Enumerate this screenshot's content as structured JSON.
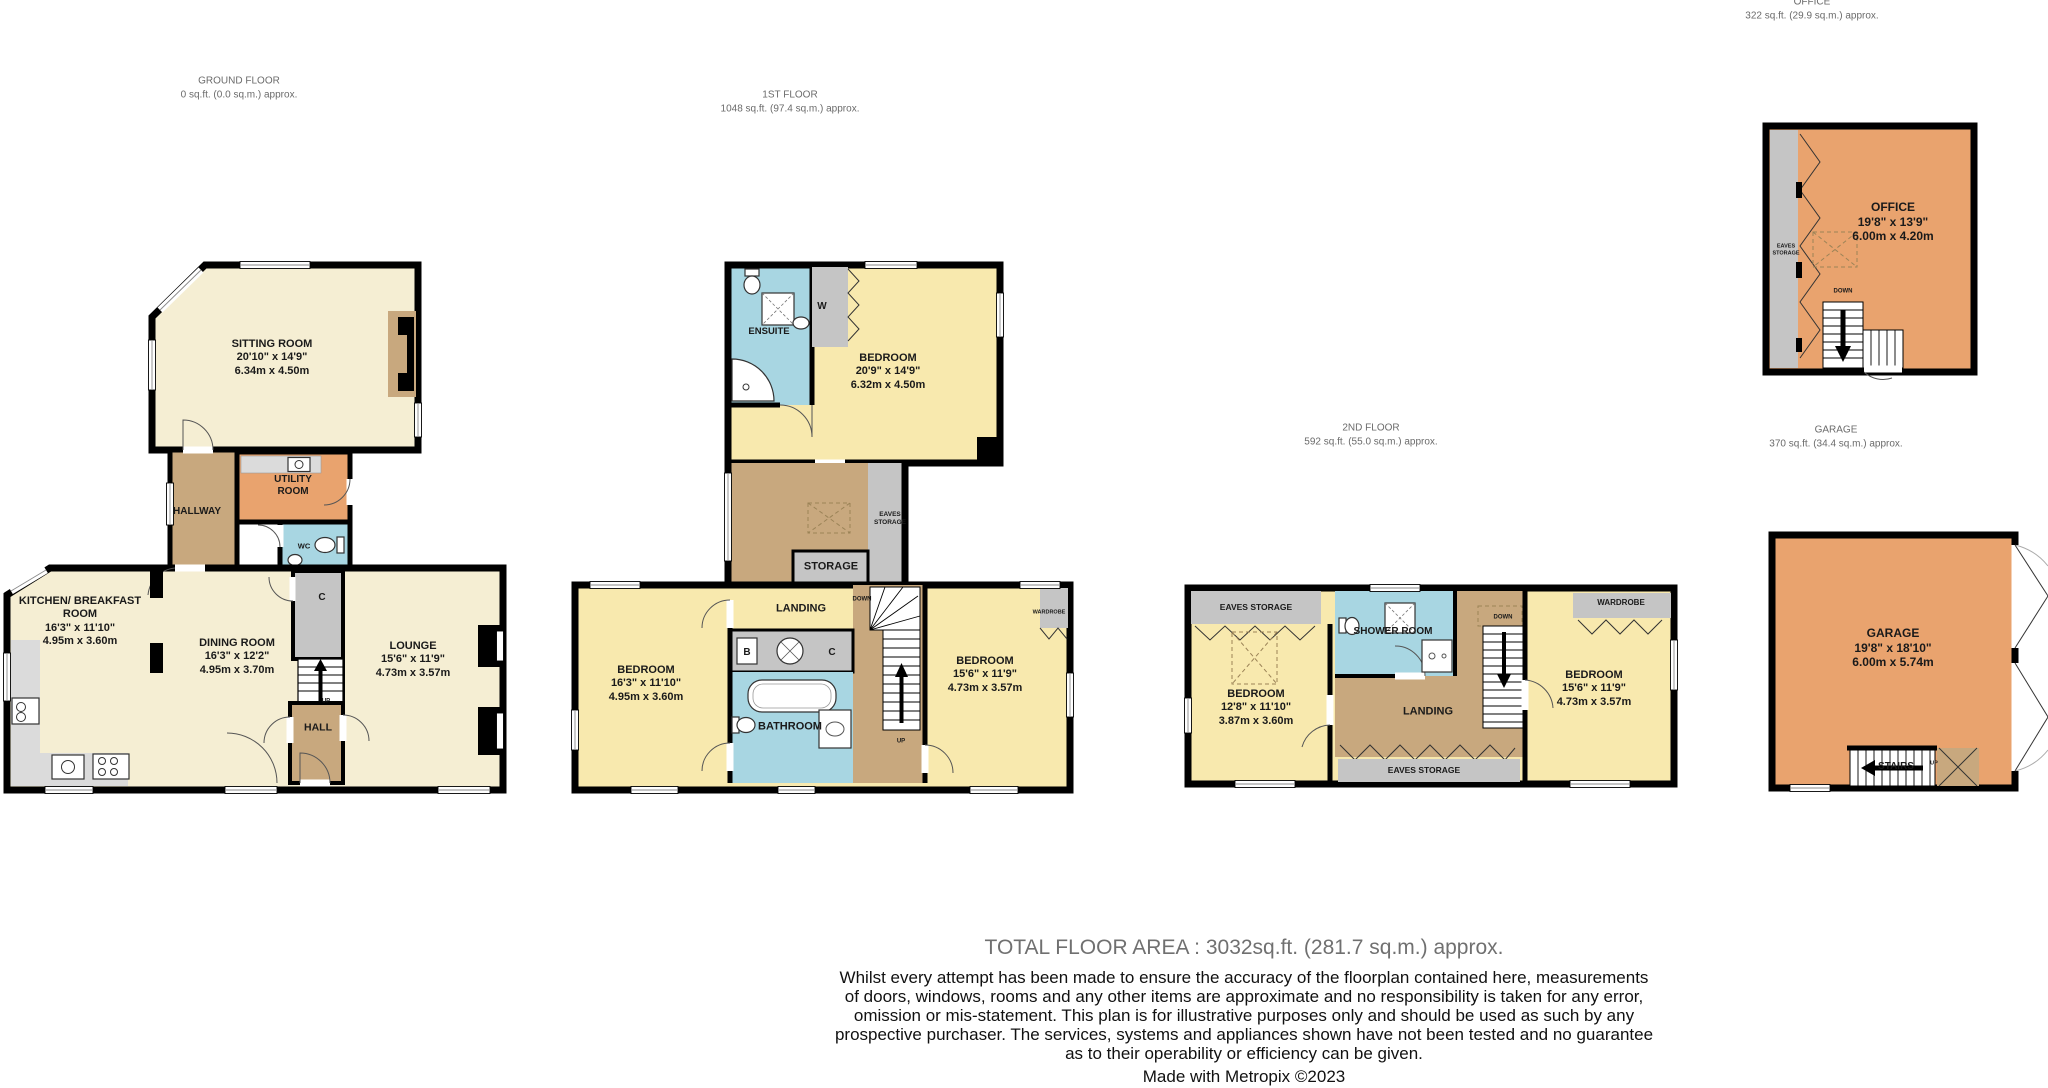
{
  "floor_titles": {
    "ground": {
      "name": "GROUND FLOOR",
      "area": "0 sq.ft. (0.0 sq.m.) approx."
    },
    "first": {
      "name": "1ST FLOOR",
      "area": "1048 sq.ft. (97.4 sq.m.) approx."
    },
    "second": {
      "name": "2ND FLOOR",
      "area": "592 sq.ft. (55.0 sq.m.) approx."
    },
    "office": {
      "name": "OFFICE",
      "area": "322 sq.ft. (29.9 sq.m.) approx."
    },
    "garage": {
      "name": "GARAGE",
      "area": "370 sq.ft. (34.4 sq.m.) approx."
    }
  },
  "rooms": {
    "sitting_room": {
      "name": "SITTING ROOM",
      "imp": "20'10\" x 14'9\"",
      "met": "6.34m x 4.50m"
    },
    "kitchen": {
      "name": "KITCHEN/ BREAKFAST ROOM",
      "imp": "16'3\" x 11'10\"",
      "met": "4.95m x 3.60m"
    },
    "dining_room": {
      "name": "DINING ROOM",
      "imp": "16'3\" x 12'2\"",
      "met": "4.95m x 3.70m"
    },
    "lounge": {
      "name": "LOUNGE",
      "imp": "15'6\" x 11'9\"",
      "met": "4.73m x 3.57m"
    },
    "bedroom_master": {
      "name": "BEDROOM",
      "imp": "20'9\" x 14'9\"",
      "met": "6.32m x 4.50m"
    },
    "bedroom_2": {
      "name": "BEDROOM",
      "imp": "16'3\" x 11'10\"",
      "met": "4.95m x 3.60m"
    },
    "bedroom_3": {
      "name": "BEDROOM",
      "imp": "15'6\" x 11'9\"",
      "met": "4.73m x 3.57m"
    },
    "bedroom_4": {
      "name": "BEDROOM",
      "imp": "12'8\" x 11'10\"",
      "met": "3.87m x 3.60m"
    },
    "bedroom_5": {
      "name": "BEDROOM",
      "imp": "15'6\" x 11'9\"",
      "met": "4.73m x 3.57m"
    },
    "office": {
      "name": "OFFICE",
      "imp": "19'8\" x 13'9\"",
      "met": "6.00m x 4.20m"
    },
    "garage": {
      "name": "GARAGE",
      "imp": "19'8\" x 18'10\"",
      "met": "6.00m x 5.74m"
    }
  },
  "labels": {
    "hallway": "HALLWAY",
    "utility_room": "UTILITY ROOM",
    "wc": "WC",
    "hall": "HALL",
    "ensuite": "ENSUITE",
    "bathroom": "BATHROOM",
    "shower_room": "SHOWER ROOM",
    "landing": "LANDING",
    "storage": "STORAGE",
    "eaves_storage": "EAVES STORAGE",
    "wardrobe": "WARDROBE",
    "stairs": "STAIRS",
    "up": "UP",
    "down": "DOWN",
    "c": "C",
    "b": "B",
    "w": "W"
  },
  "colors": {
    "room_cream": "#F5EED3",
    "room_yellow": "#F8E9AE",
    "room_tan": "#C8A87E",
    "room_orange": "#E9A36E",
    "room_blue": "#A8D6E2",
    "room_gray": "#C5C5C5",
    "counter_gray": "#DBDBDB",
    "wall": "#000000"
  },
  "footer": {
    "total": "TOTAL FLOOR AREA : 3032sq.ft. (281.7 sq.m.) approx.",
    "disclaimer": "Whilst every attempt has been made to ensure the accuracy of the floorplan contained here, measurements\nof doors, windows, rooms and any other items are approximate and no responsibility is taken for any error,\nomission or mis-statement. This plan is for illustrative purposes only and should be used as such by any\nprospective purchaser. The services, systems and appliances shown have not been tested and no guarantee\nas to their operability or efficiency can be given.",
    "made_with": "Made with Metropix ©2023"
  }
}
